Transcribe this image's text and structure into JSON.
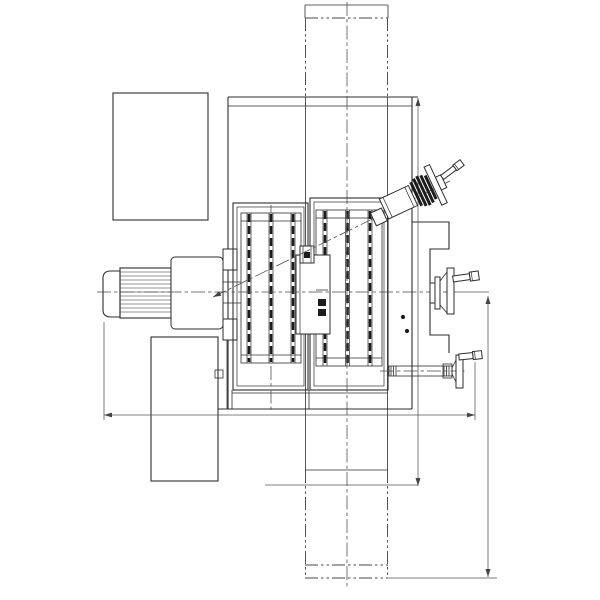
{
  "page": {
    "background": "#ffffff"
  },
  "drawing": {
    "type": "engineering-line-drawing",
    "subject": "machine-top-view-with-rotary-table-motor-and-handwheels",
    "text_labels": [],
    "colors": {
      "main_line": "#2e2e2e",
      "thin_line": "#555555",
      "centerline": "#4a4a4a",
      "dark_fill": "#1c1c1c",
      "background": "#ffffff"
    },
    "parts": {
      "column": "vertical-column-phantom-outline",
      "body": "machine-body",
      "motor": "finned-electric-motor",
      "gearbox": "gearbox-housing",
      "table_left": "t-slot-table-left-block",
      "table_right": "t-slot-table-right-block",
      "angled_handwheel": "inclined-crank-handwheel",
      "side_handwheel": "right-side-crank-handwheel",
      "bottom_handwheel": "lower-right-crank-handwheel",
      "dimensions": "three-unlabeled-dimension-lines"
    }
  }
}
